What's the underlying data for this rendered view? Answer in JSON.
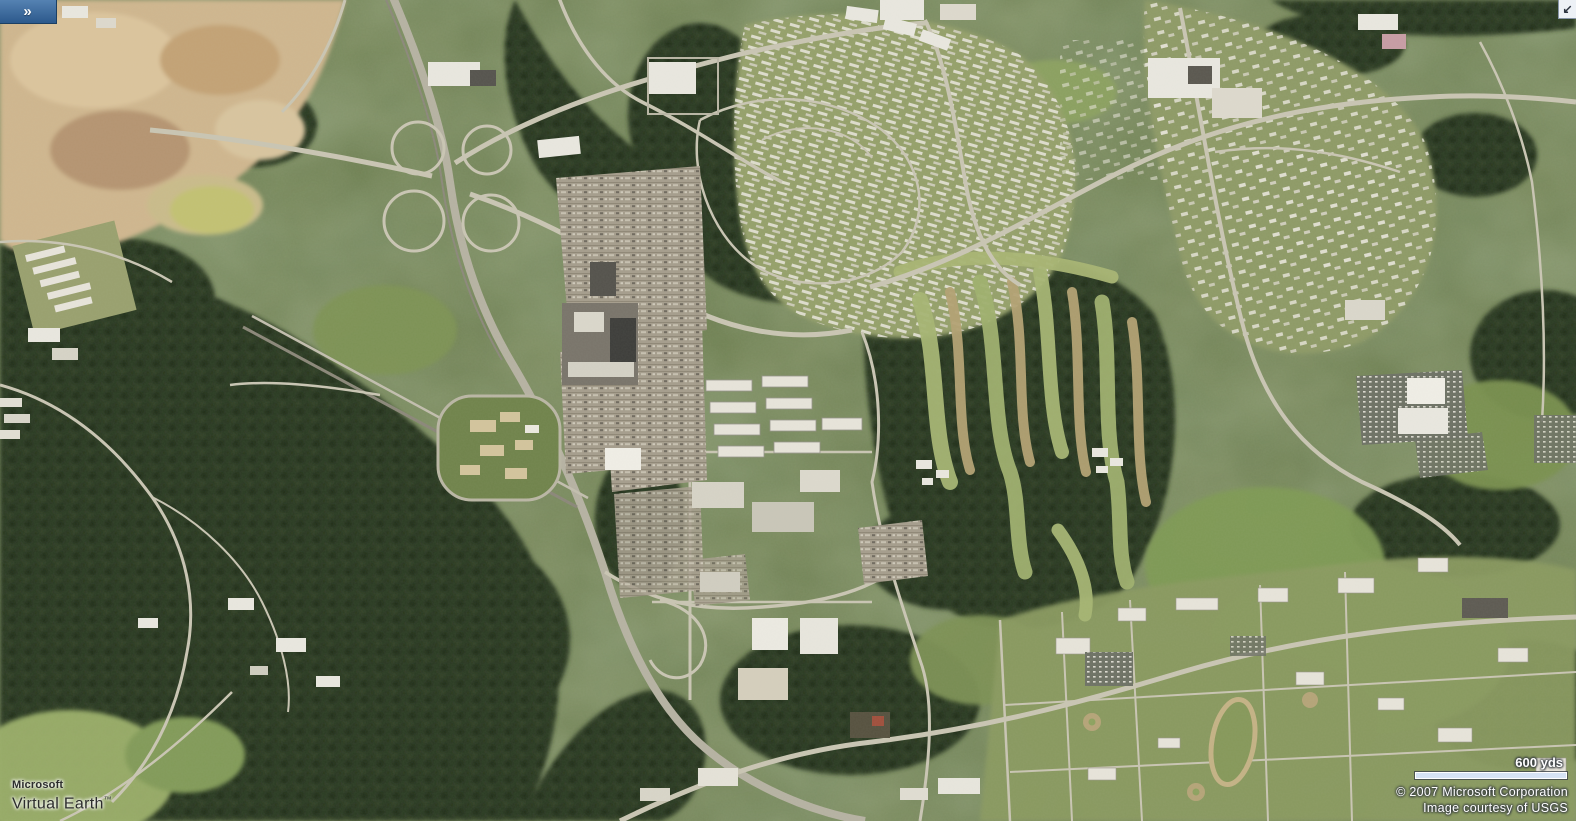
{
  "branding": {
    "microsoft": "Microsoft",
    "product": "Virtual Earth",
    "trademark": "™"
  },
  "controls": {
    "expand_panel_glyph": "»",
    "expand_panel_icon": "double-chevron-right",
    "corner_arrow_glyph": "↙",
    "corner_arrow_icon": "arrow-down-left"
  },
  "scale_bar": {
    "label": "600 yds"
  },
  "attribution": {
    "copyright": "© 2007 Microsoft Corporation",
    "courtesy": "Image courtesy of USGS"
  },
  "colors": {
    "panel_tab_top": "#5582b2",
    "panel_tab_bottom": "#2c598c",
    "panel_tab_edge": "#1b3f63",
    "corner_button_bg": "#edf1f6",
    "corner_button_fg": "#2c3440",
    "scale_bar_fill": "#d6e3f5",
    "scale_bar_border": "#ffffff",
    "overlay_text": "#ffffff",
    "logo_text": "#2d2d2d"
  }
}
